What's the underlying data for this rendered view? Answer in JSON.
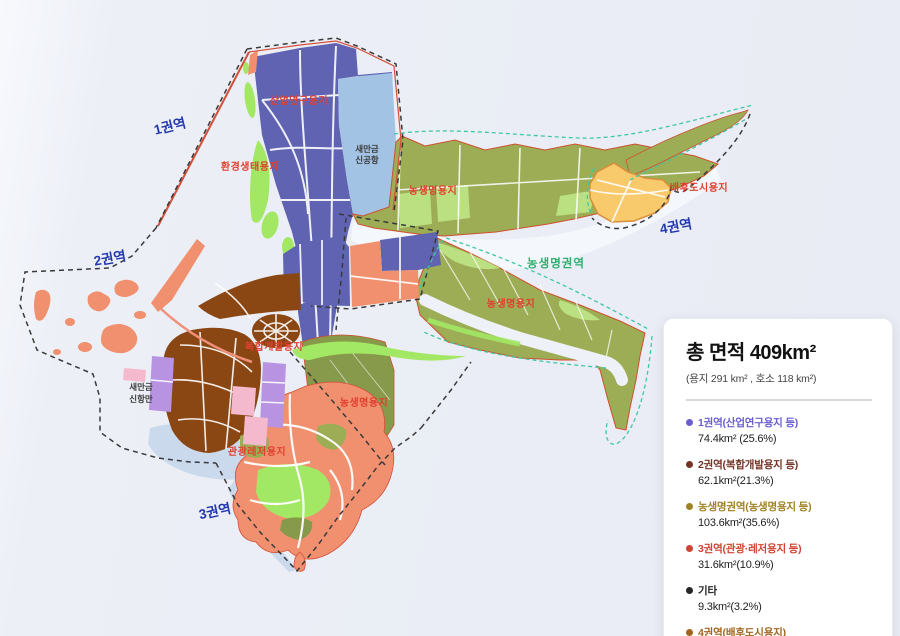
{
  "map": {
    "colors": {
      "industrial": "#5f63b2",
      "airport": "#a3c3e4",
      "agri": "#9cad55",
      "agri_dark": "#87994a",
      "patch_green": "#bbe081",
      "bright_green": "#a3e865",
      "tourism_salmon": "#f1906e",
      "complex_brown": "#8a4714",
      "city_yellow": "#f8ca6b",
      "city_stroke": "#d98e3b",
      "port_purple": "#b793e2",
      "port_pink": "#f5b9ce",
      "water": "#cbd9ec",
      "river": "#f4f7fc",
      "red_line": "#d4503a",
      "teal_dash": "#3fc8a4",
      "black_dash": "#3a3a3a",
      "zone_label": "#2438ae",
      "land_label": "#e0402f",
      "region_label": "#2fae6d",
      "facility_label": "#3a3a3a"
    },
    "zone_labels": [
      {
        "text": "1권역"
      },
      {
        "text": "2권역"
      },
      {
        "text": "3권역"
      },
      {
        "text": "4권역"
      }
    ],
    "land_labels": [
      {
        "text": "산업연구용지"
      },
      {
        "text": "환경생태용지"
      },
      {
        "text": "농생명용지"
      },
      {
        "text": "배후도시용지"
      },
      {
        "text": "농생명용지"
      },
      {
        "text": "복합개발용지"
      },
      {
        "text": "농생명용지"
      },
      {
        "text": "관광레저용지"
      }
    ],
    "region_label": {
      "text": "농생명권역"
    },
    "facility_labels": [
      {
        "line1": "새만금",
        "line2": "신공항"
      },
      {
        "line1": "새만금",
        "line2": "신항만"
      }
    ]
  },
  "legend": {
    "title": "총 면적 409km²",
    "subtitle": "(용지 291 km² , 호소 118 km²)",
    "items": [
      {
        "label": "1권역(산업연구용지 등)",
        "value": "74.4km² (25.6%)",
        "color": "#6a5ed0"
      },
      {
        "label": "2권역(복합개발용지 등)",
        "value": "62.1km²(21.3%)",
        "color": "#743325"
      },
      {
        "label": "농생명권역(농생명용지 등)",
        "value": "103.6km²(35.6%)",
        "color": "#a08222"
      },
      {
        "label": "3권역(관광·레저용지 등)",
        "value": "31.6km²(10.9%)",
        "color": "#cf4434"
      },
      {
        "label": "기타",
        "value": "9.3km²(3.2%)",
        "color": "#262626"
      },
      {
        "label": "4권역(배후도시용지)",
        "value": "10.0km²(3.4%)",
        "color": "#a0661f"
      }
    ]
  }
}
